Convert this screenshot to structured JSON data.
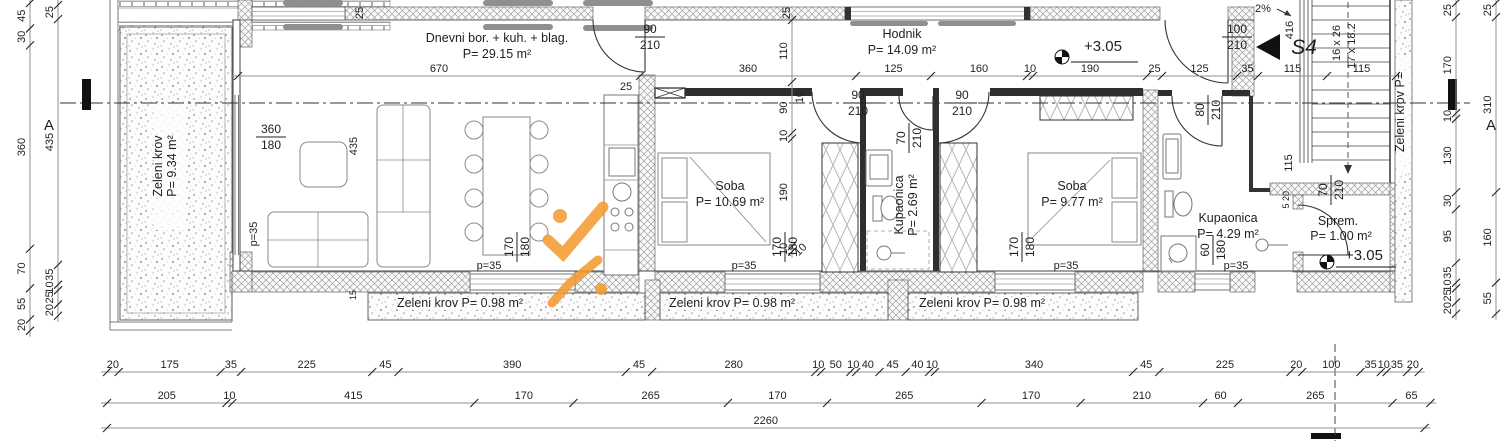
{
  "drawing": {
    "type": "architectural-floor-plan",
    "section_label": "A",
    "plan_mark": "S4",
    "accent_color": "#f49b33",
    "line_color": "#333333"
  },
  "labels": [
    {
      "t": "Dnevni bor. + kuh. + blag.",
      "x": 497,
      "y": 42,
      "c": "room",
      "n": "room-label-living"
    },
    {
      "t": "P= 29.15 m²",
      "x": 497,
      "y": 58,
      "c": "room",
      "n": "room-area-living"
    },
    {
      "t": "Hodnik",
      "x": 902,
      "y": 38,
      "c": "room",
      "n": "room-label-hallway"
    },
    {
      "t": "P= 14.09 m²",
      "x": 902,
      "y": 54,
      "c": "room",
      "n": "room-area-hallway"
    },
    {
      "t": "Soba",
      "x": 730,
      "y": 190,
      "c": "room",
      "n": "room-label-bedroom-1"
    },
    {
      "t": "P= 10.69 m²",
      "x": 730,
      "y": 206,
      "c": "room",
      "n": "room-area-bedroom-1"
    },
    {
      "t": "Soba",
      "x": 1072,
      "y": 190,
      "c": "room",
      "n": "room-label-bedroom-2"
    },
    {
      "t": "P= 9.77 m²",
      "x": 1072,
      "y": 206,
      "c": "room",
      "n": "room-area-bedroom-2"
    },
    {
      "t": "Kupaonica",
      "x": 903,
      "y": 205,
      "r": -90,
      "c": "room",
      "n": "room-label-bathroom-1"
    },
    {
      "t": "P= 2.69 m²",
      "x": 917,
      "y": 205,
      "r": -90,
      "c": "room",
      "n": "room-area-bathroom-1"
    },
    {
      "t": "Kupaonica",
      "x": 1228,
      "y": 222,
      "c": "room",
      "n": "room-label-bathroom-2"
    },
    {
      "t": "P= 4.29 m²",
      "x": 1228,
      "y": 238,
      "c": "room",
      "n": "room-area-bathroom-2"
    },
    {
      "t": "Sprem.",
      "x": 1338,
      "y": 225,
      "c": "room",
      "n": "room-label-storage"
    },
    {
      "t": "P= 1.00 m²",
      "x": 1341,
      "y": 240,
      "c": "room",
      "n": "room-area-storage"
    },
    {
      "t": "Zeleni krov",
      "x": 162,
      "y": 166,
      "r": -90,
      "c": "room",
      "n": "green-roof-left-label"
    },
    {
      "t": "P= 9.34 m²",
      "x": 176,
      "y": 166,
      "r": -90,
      "c": "room",
      "n": "green-roof-left-area"
    },
    {
      "t": "Zeleni krov P= 0.98 m²",
      "x": 460,
      "y": 307,
      "c": "room",
      "n": "green-roof-strip-1-label"
    },
    {
      "t": "Zeleni krov P= 0.98 m²",
      "x": 732,
      "y": 307,
      "c": "room",
      "n": "green-roof-strip-2-label"
    },
    {
      "t": "Zeleni krov P= 0.98 m²",
      "x": 982,
      "y": 307,
      "c": "room",
      "n": "green-roof-strip-3-label"
    },
    {
      "t": "Zeleni krov P=",
      "x": 1404,
      "y": 112,
      "r": -90,
      "c": "room",
      "n": "green-roof-right-label"
    },
    {
      "t": "+3.05",
      "x": 1103,
      "y": 51,
      "c": "big",
      "n": "elevation-value-hallway"
    },
    {
      "t": "+3.05",
      "x": 1364,
      "y": 260,
      "c": "big",
      "n": "elevation-value-storage"
    },
    {
      "t": "S4",
      "x": 1304,
      "y": 54,
      "c": "s4",
      "n": "plan-mark-s4"
    },
    {
      "t": "A",
      "x": 49,
      "y": 130,
      "c": "big",
      "n": "section-letter-left"
    },
    {
      "t": "A",
      "x": 1491,
      "y": 130,
      "c": "big",
      "n": "section-letter-right"
    },
    {
      "t": "2%",
      "x": 1263,
      "y": 12,
      "c": "dim",
      "n": "slope-label"
    },
    {
      "t": "416",
      "x": 1293,
      "y": 30,
      "r": -90,
      "c": "dim",
      "n": "stair-dim-416"
    },
    {
      "t": "16 x 26",
      "x": 1340,
      "y": 43,
      "r": -90,
      "c": "dim",
      "n": "stair-treads-label-1"
    },
    {
      "t": "17 x 18.2",
      "x": 1355,
      "y": 46,
      "r": -90,
      "c": "dim",
      "n": "stair-treads-label-2"
    },
    {
      "t": "25",
      "x": 363,
      "y": 13,
      "r": -90,
      "c": "dim",
      "n": "dim-25-top-left"
    },
    {
      "t": "25",
      "x": 790,
      "y": 13,
      "r": -90,
      "c": "dim",
      "n": "dim-25-top-mid"
    },
    {
      "t": "25",
      "x": 626,
      "y": 90,
      "c": "dim",
      "n": "dim-25-kitchen"
    },
    {
      "t": "10",
      "x": 803,
      "y": 97,
      "r": -90,
      "c": "dim",
      "n": "dim-10-hall"
    },
    {
      "t": "435",
      "x": 357,
      "y": 146,
      "r": -90,
      "c": "dim",
      "n": "dim-435-living"
    },
    {
      "t": "p=35",
      "x": 257,
      "y": 234,
      "r": -90,
      "c": "dim",
      "n": "parapet-living-left"
    },
    {
      "t": "p=35",
      "x": 489,
      "y": 269,
      "c": "dim",
      "n": "parapet-kitchen"
    },
    {
      "t": "p=35",
      "x": 744,
      "y": 269,
      "c": "dim",
      "n": "parapet-bedroom-1"
    },
    {
      "t": "p=35",
      "x": 1066,
      "y": 269,
      "c": "dim",
      "n": "parapet-bedroom-2"
    },
    {
      "t": "p=35",
      "x": 1236,
      "y": 269,
      "c": "dim",
      "n": "parapet-bathroom-2"
    },
    {
      "t": "115",
      "x": 1292,
      "y": 163,
      "r": -90,
      "c": "dim",
      "n": "dim-115-stair-hall"
    },
    {
      "t": "20",
      "x": 1289,
      "y": 196,
      "r": -90,
      "c": "small",
      "n": "dim-20-storage"
    },
    {
      "t": "5",
      "x": 1289,
      "y": 206,
      "r": -90,
      "c": "small",
      "n": "dim-5-storage"
    },
    {
      "t": "10",
      "x": 803,
      "y": 252,
      "r": -45,
      "c": "dim",
      "n": "dim-10-window"
    },
    {
      "t": "15",
      "x": 356,
      "y": 295,
      "r": -90,
      "c": "small",
      "n": "dim-15-sill"
    }
  ],
  "fractions": [
    {
      "a": "90",
      "b": "210",
      "x": 650,
      "y": 33,
      "n": "door-mark-terrace"
    },
    {
      "a": "90",
      "b": "210",
      "x": 858,
      "y": 99,
      "n": "door-mark-bedroom-1"
    },
    {
      "a": "90",
      "b": "210",
      "x": 962,
      "y": 99,
      "n": "door-mark-bedroom-2"
    },
    {
      "a": "70",
      "b": "210",
      "x": 905,
      "y": 138,
      "r": -90,
      "n": "door-mark-bathroom-1"
    },
    {
      "a": "100",
      "b": "210",
      "x": 1237,
      "y": 33,
      "n": "door-mark-entrance"
    },
    {
      "a": "80",
      "b": "210",
      "x": 1204,
      "y": 110,
      "r": -90,
      "n": "door-mark-bathroom-2"
    },
    {
      "a": "70",
      "b": "210",
      "x": 1327,
      "y": 190,
      "r": -90,
      "n": "door-mark-storage"
    },
    {
      "a": "360",
      "b": "180",
      "x": 271,
      "y": 133,
      "n": "window-mark-living"
    },
    {
      "a": "170",
      "b": "180",
      "x": 513,
      "y": 247,
      "r": -90,
      "n": "window-mark-kitchen"
    },
    {
      "a": "170",
      "b": "180",
      "x": 781,
      "y": 247,
      "r": -90,
      "n": "window-mark-bedroom-1"
    },
    {
      "a": "170",
      "b": "180",
      "x": 1018,
      "y": 247,
      "r": -90,
      "n": "window-mark-bedroom-2"
    },
    {
      "a": "60",
      "b": "180",
      "x": 1209,
      "y": 250,
      "r": -90,
      "n": "window-mark-bathroom-2"
    }
  ],
  "chains": [
    {
      "o": "h",
      "pos": 76,
      "start": 238,
      "ppc": 0.6,
      "values": [
        670,
        360,
        125,
        160,
        10,
        190,
        25,
        125,
        35,
        115,
        115
      ],
      "n": "chain-top-interior"
    },
    {
      "o": "h",
      "pos": 372,
      "start": 107,
      "ppc": 0.583,
      "values": [
        20,
        175,
        35,
        225,
        45,
        390,
        45,
        280,
        10,
        50,
        10,
        40,
        45,
        40,
        10,
        340,
        45,
        225,
        20,
        100,
        35,
        10,
        35,
        20
      ],
      "n": "chain-bottom-detail"
    },
    {
      "o": "h",
      "pos": 403,
      "start": 107,
      "ppc": 0.583,
      "values": [
        205,
        10,
        415,
        170,
        265,
        170,
        265,
        170,
        210,
        60,
        265,
        65
      ],
      "n": "chain-bottom-openings"
    },
    {
      "o": "h",
      "pos": 428,
      "start": 107,
      "ppc": 0.583,
      "values": [
        2260
      ],
      "n": "chain-bottom-total"
    },
    {
      "o": "v",
      "pos": 30,
      "start": 3,
      "ppc": 0.565,
      "values": [
        45,
        30,
        360,
        70,
        55,
        20
      ],
      "n": "chain-left-outer"
    },
    {
      "o": "v",
      "pos": 58,
      "start": 5,
      "ppc": 0.565,
      "values": [
        25,
        435,
        35,
        10,
        25,
        20
      ],
      "n": "chain-left-inner"
    },
    {
      "o": "v",
      "pos": 1456,
      "start": 3,
      "ppc": 0.565,
      "values": [
        25,
        170,
        10,
        130,
        30,
        95,
        35,
        10,
        25,
        20
      ],
      "n": "chain-right-inner"
    },
    {
      "o": "v",
      "pos": 1496,
      "start": 3,
      "ppc": 0.565,
      "values": [
        25,
        310,
        160,
        55
      ],
      "n": "chain-right-outer"
    },
    {
      "o": "v",
      "pos": 792,
      "start": 20,
      "ppc": 0.565,
      "values": [
        110,
        90,
        10,
        190,
        10
      ],
      "n": "chain-bedroom-1-vertical"
    }
  ]
}
